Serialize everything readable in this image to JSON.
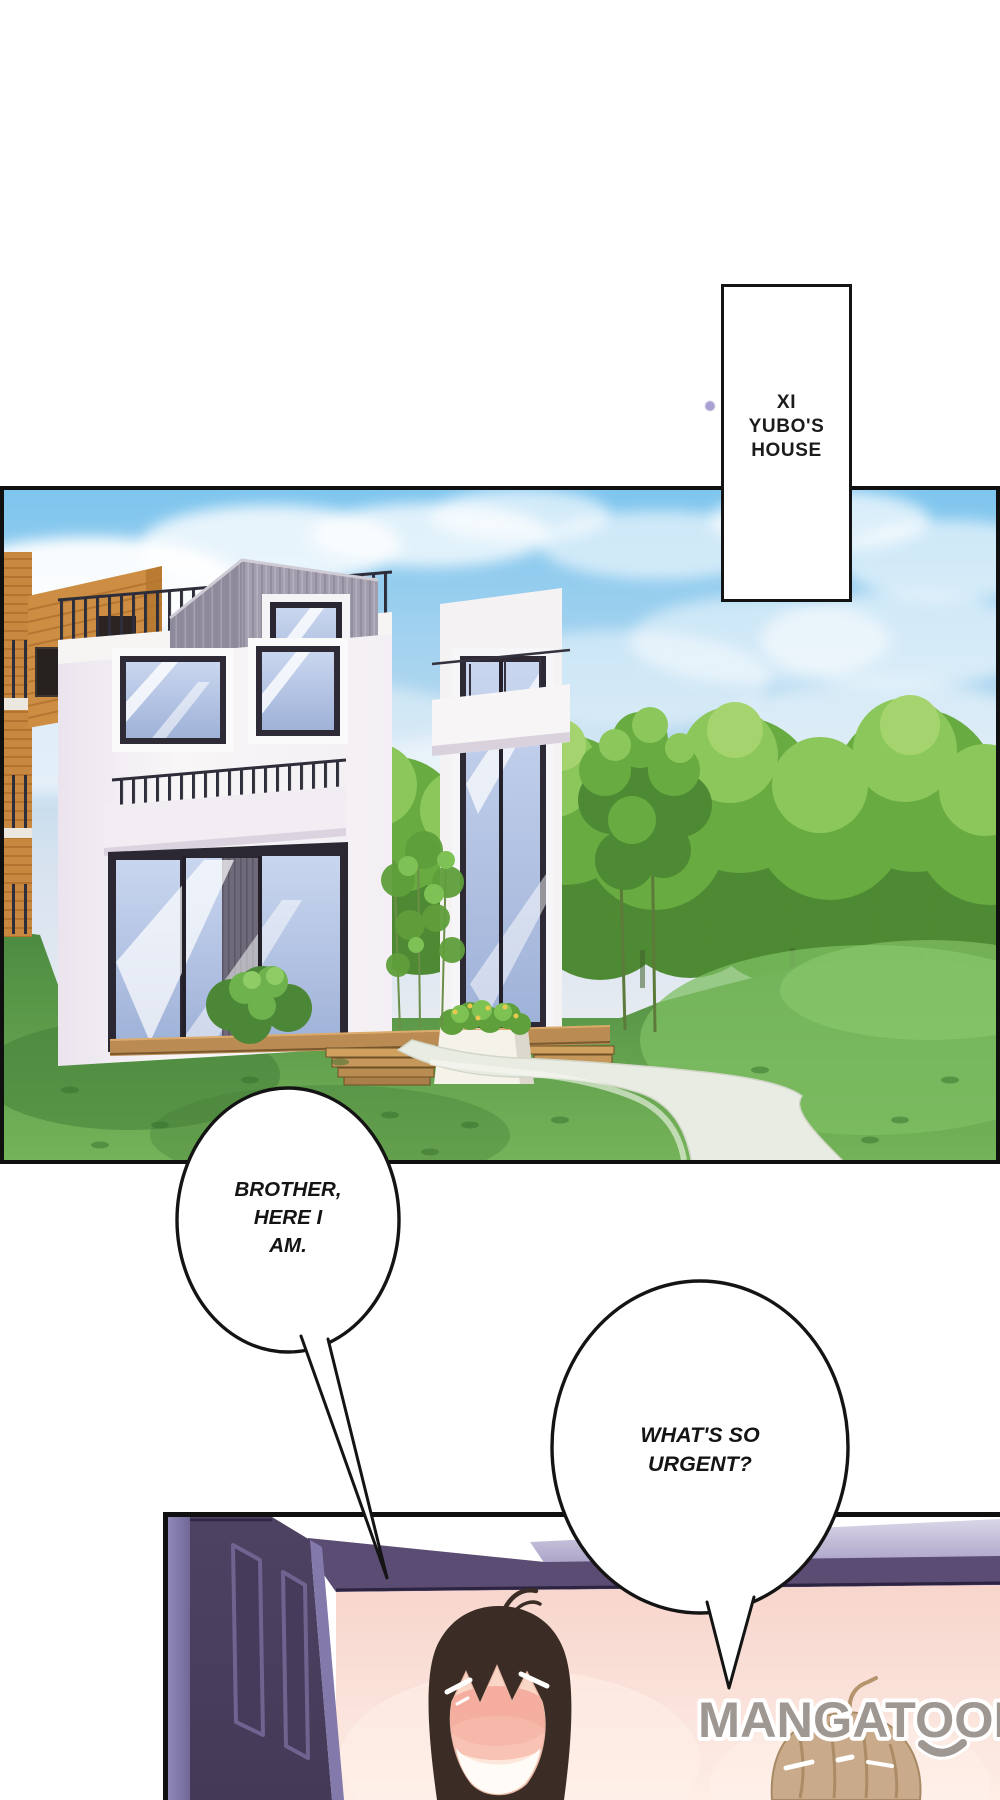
{
  "page": {
    "type": "comic-page",
    "width": 1000,
    "height": 1800,
    "background": "#ffffff"
  },
  "caption_box": {
    "lines": [
      "XI",
      "YUBO'S",
      "HOUSE"
    ],
    "text_color": "#1c1a1d",
    "border_color": "#141414",
    "fill": "#ffffff"
  },
  "speech_bubbles": [
    {
      "name": "bubble-brother-here-i-am",
      "lines": [
        "BROTHER,",
        "HERE I",
        "AM."
      ],
      "fill": "#ffffff",
      "outline": "#141414"
    },
    {
      "name": "bubble-whats-so-urgent",
      "lines": [
        "WHAT'S SO",
        "URGENT?"
      ],
      "fill": "#ffffff",
      "outline": "#141414"
    }
  ],
  "watermark": {
    "text": "MANGATOON",
    "color": "#9e9792",
    "outline": "#ffffff"
  },
  "decor": {
    "dot_color": "#a89fd2"
  },
  "panels": [
    {
      "name": "house-exterior-panel",
      "alt": "modern white house with wood accents, hedge, lawn and curved path"
    },
    {
      "name": "room-interior-panel",
      "alt": "open purple door into pink room with two characters"
    }
  ],
  "palette": {
    "sky_blue": "#7ec5ee",
    "tree_green": "#68ab41",
    "lawn_green": "#5f9c4a",
    "house_white": "#f6f3f4",
    "wood_orange": "#c9883f",
    "cube_gray": "#a39eae",
    "door_purple": "#4b3f61",
    "door_trim_lavender": "#9089b8",
    "wall_molding_purple": "#5a4c72",
    "room_pink": "#f8d8cf",
    "hair_dark_brown": "#3b2d26",
    "hair_light_brown": "#c9aa8a",
    "skin": "#fde7da",
    "blush_pink": "#f3a89a"
  }
}
